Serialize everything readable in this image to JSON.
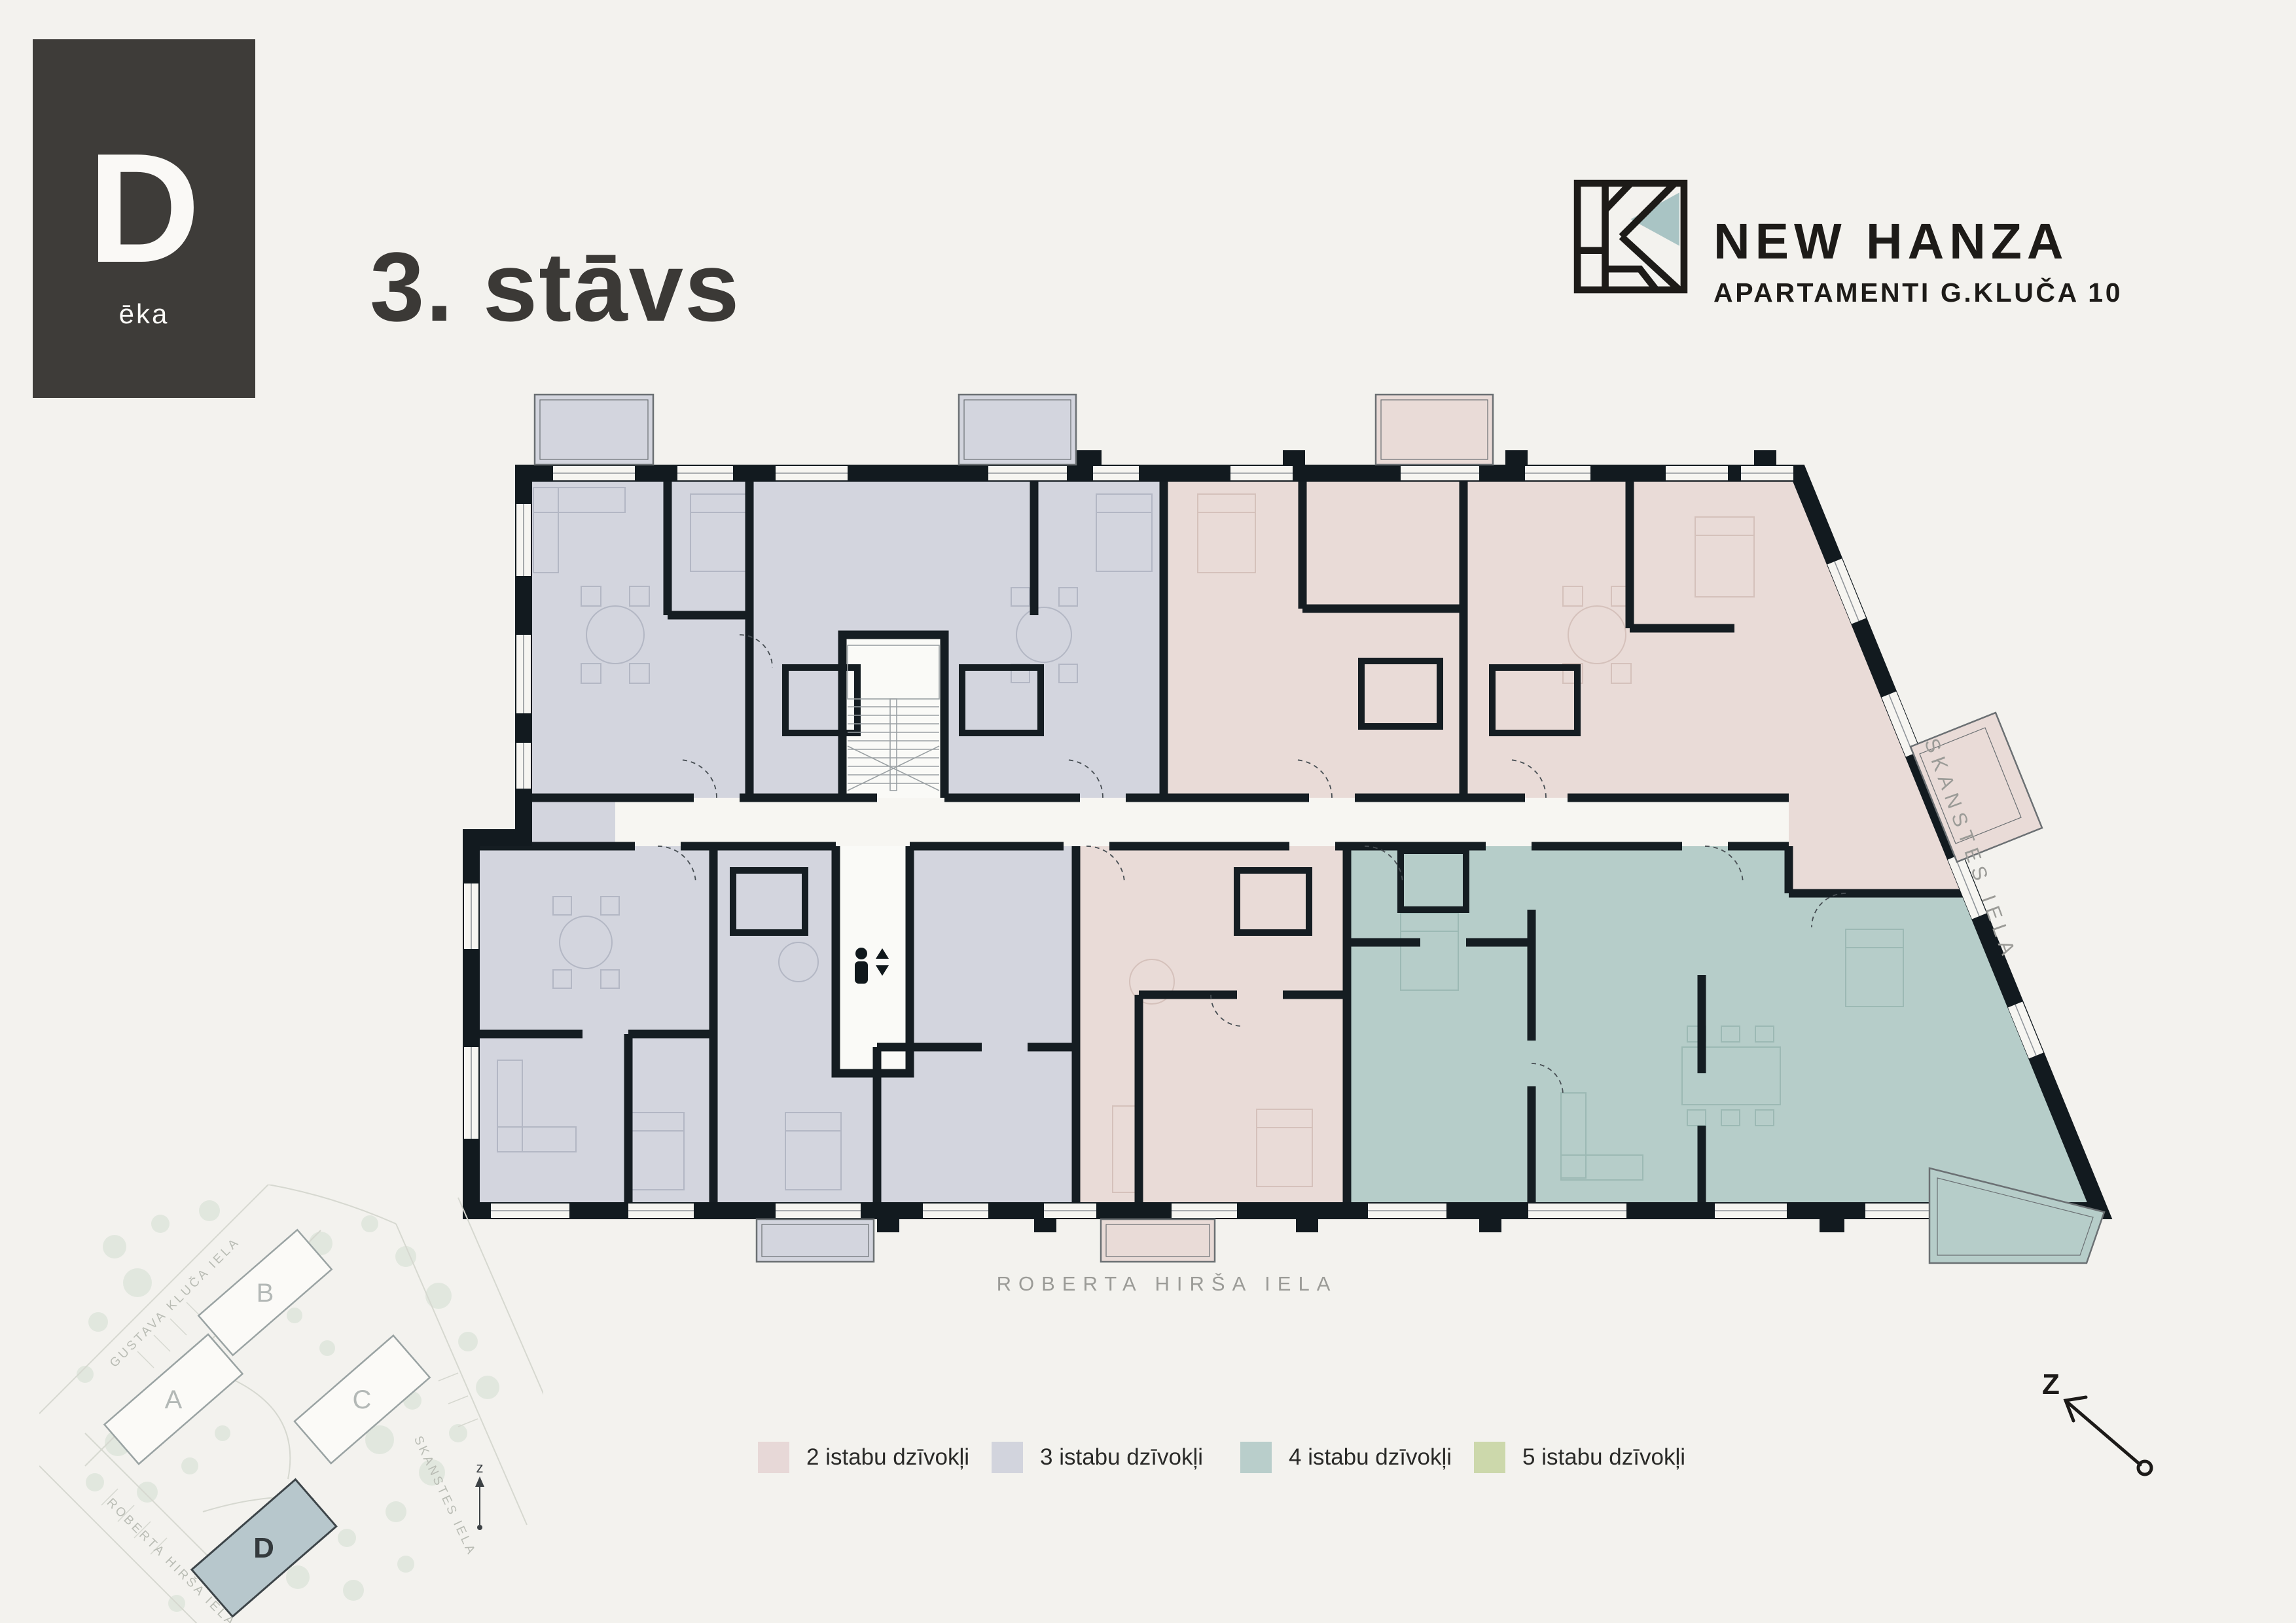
{
  "header": {
    "building_badge": {
      "letter": "D",
      "sublabel": "ēka"
    },
    "floor_title": "3. stāvs",
    "brand": {
      "title": "NEW HANZA",
      "subtitle": "APARTAMENTI G.KLUČA 10"
    }
  },
  "plan": {
    "street_bottom": "ROBERTA HIRŠA IELA",
    "street_right": "SKANSTES IELA"
  },
  "site_map": {
    "streets": {
      "top_left": "GUSTAVA KLUČA IELA",
      "bottom_left": "ROBERTA HIRŠA IELA",
      "right": "SKANSTES IELA"
    },
    "buildings": [
      {
        "label": "A"
      },
      {
        "label": "B"
      },
      {
        "label": "C"
      },
      {
        "label": "D"
      }
    ],
    "highlighted_building": "D",
    "north_label": "z"
  },
  "legend": {
    "items": [
      {
        "label": "2 istabu dzīvokļi",
        "color": "#e7d8d7"
      },
      {
        "label": "3 istabu dzīvokļi",
        "color": "#d2d4dd"
      },
      {
        "label": "4 istabu dzīvokļi",
        "color": "#b9cecb"
      },
      {
        "label": "5 istabu dzīvokļi",
        "color": "#ccd8ab"
      }
    ]
  },
  "compass": {
    "north_label": "Z"
  },
  "colors": {
    "background": "#f3f2ee",
    "wall": "#121a1f",
    "badge_bg": "#3e3c39",
    "logo_accent": "#a9c4c4",
    "apt_2room": "#e9dbd7",
    "apt_3room": "#d3d5de",
    "apt_4room": "#b6cdc9",
    "apt_5room": "#ccd8ab",
    "street_text": "#9b9b97"
  }
}
